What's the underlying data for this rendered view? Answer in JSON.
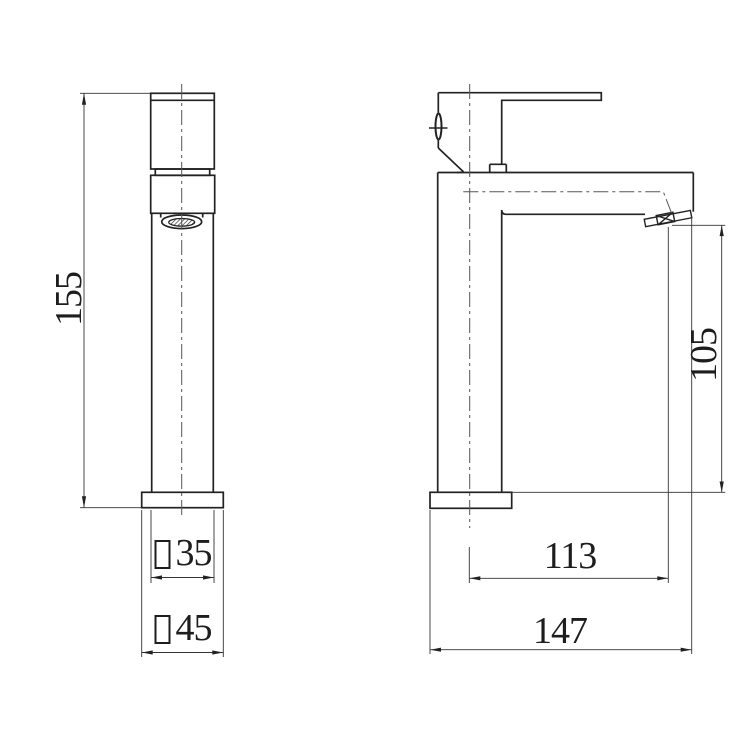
{
  "drawing": {
    "background": "#ffffff",
    "object_line_color": "#222222",
    "dimension_line_color": "#333333",
    "centerline_color": "#555555",
    "views": [
      "front-view",
      "side-view"
    ],
    "dimensions": {
      "overall_height": {
        "value": "155",
        "orientation": "vertical",
        "view": "front"
      },
      "body_section": {
        "symbol": "□",
        "value": "35",
        "orientation": "horizontal",
        "view": "front"
      },
      "base_section": {
        "symbol": "□",
        "value": "45",
        "orientation": "horizontal",
        "view": "front"
      },
      "outlet_height": {
        "value": "105",
        "orientation": "vertical",
        "view": "side"
      },
      "center_to_outlet": {
        "value": "113",
        "orientation": "horizontal",
        "view": "side"
      },
      "overall_depth": {
        "value": "147",
        "orientation": "horizontal",
        "view": "side"
      }
    }
  }
}
